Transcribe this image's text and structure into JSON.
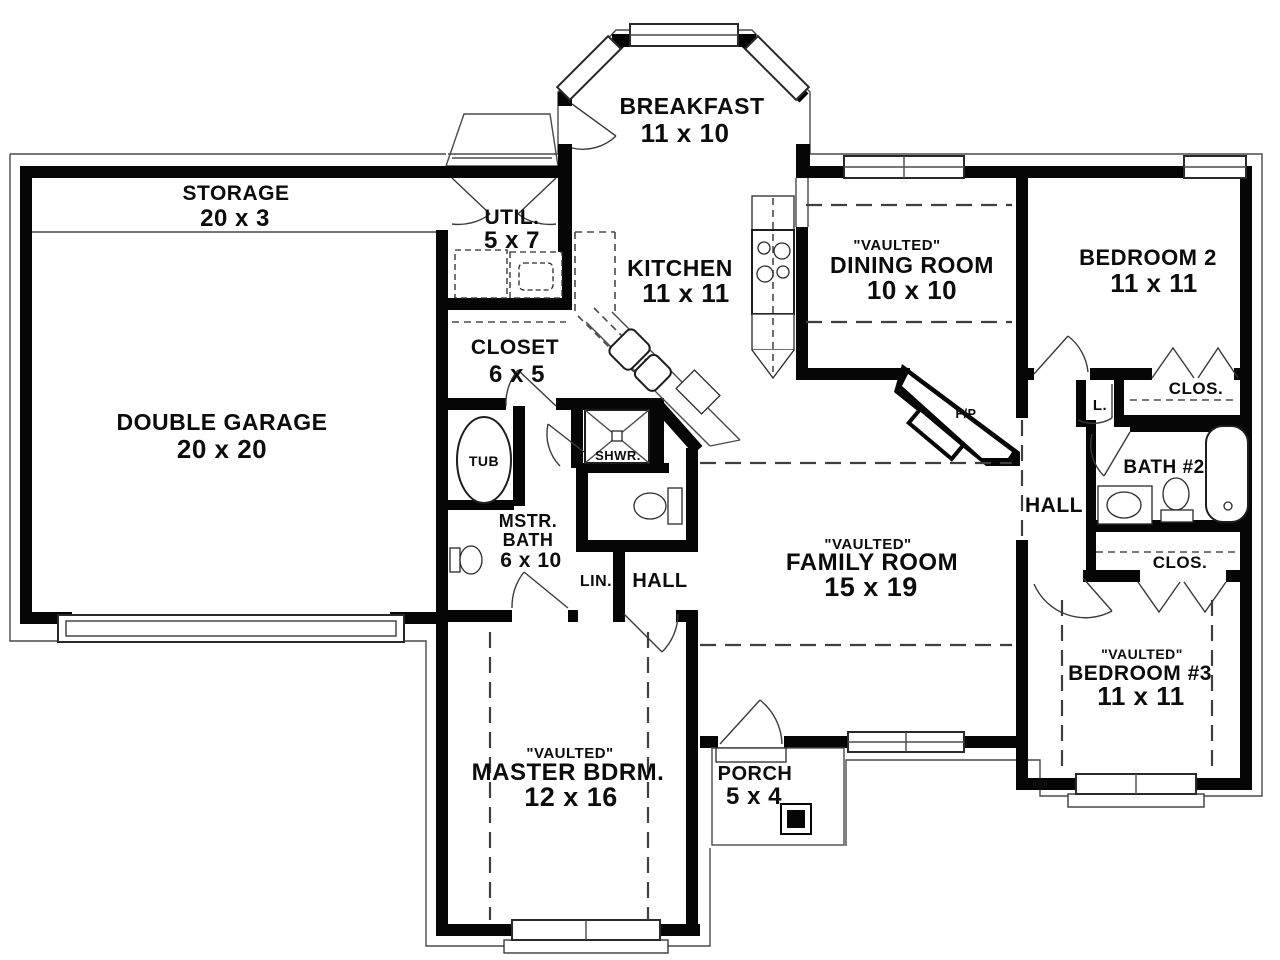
{
  "plan": {
    "storage": {
      "name": "STORAGE",
      "dims": "20 x 3"
    },
    "garage": {
      "name": "DOUBLE GARAGE",
      "dims": "20 x 20"
    },
    "breakfast": {
      "name": "BREAKFAST",
      "dims": "11 x 10"
    },
    "util": {
      "name": "UTIL.",
      "dims": "5 x 7"
    },
    "kitchen": {
      "name": "KITCHEN",
      "dims": "11 x 11"
    },
    "closet": {
      "name": "CLOSET",
      "dims": "6 x 5"
    },
    "dining": {
      "tag": "\"VAULTED\"",
      "name": "DINING ROOM",
      "dims": "10 x 10"
    },
    "bedroom2": {
      "name": "BEDROOM 2",
      "dims": "11 x 11"
    },
    "bedroom2_closet": {
      "name": "CLOS."
    },
    "linen_right": {
      "name": "L."
    },
    "bath2": {
      "name": "BATH #2"
    },
    "hall_right": {
      "name": "HALL"
    },
    "bedroom3_closet": {
      "name": "CLOS."
    },
    "family": {
      "tag": "\"VAULTED\"",
      "name": "FAMILY ROOM",
      "dims": "15 x 19"
    },
    "fireplace": {
      "name": "F/P"
    },
    "tub": {
      "name": "TUB"
    },
    "shower": {
      "name": "SHWR."
    },
    "master_bath": {
      "name1": "MSTR.",
      "name2": "BATH",
      "dims": "6 x 10"
    },
    "linen": {
      "name": "LIN."
    },
    "hall": {
      "name": "HALL"
    },
    "master": {
      "tag": "\"VAULTED\"",
      "name": "MASTER BDRM.",
      "dims": "12 x 16"
    },
    "porch": {
      "name": "PORCH",
      "dims": "5 x 4"
    },
    "bedroom3": {
      "tag": "\"VAULTED\"",
      "name": "BEDROOM #3",
      "dims": "11 x 11"
    }
  },
  "colors": {
    "wall": "#060606",
    "line": "#4a4a4a",
    "background": "#ffffff",
    "text": "#0c0c0c"
  }
}
